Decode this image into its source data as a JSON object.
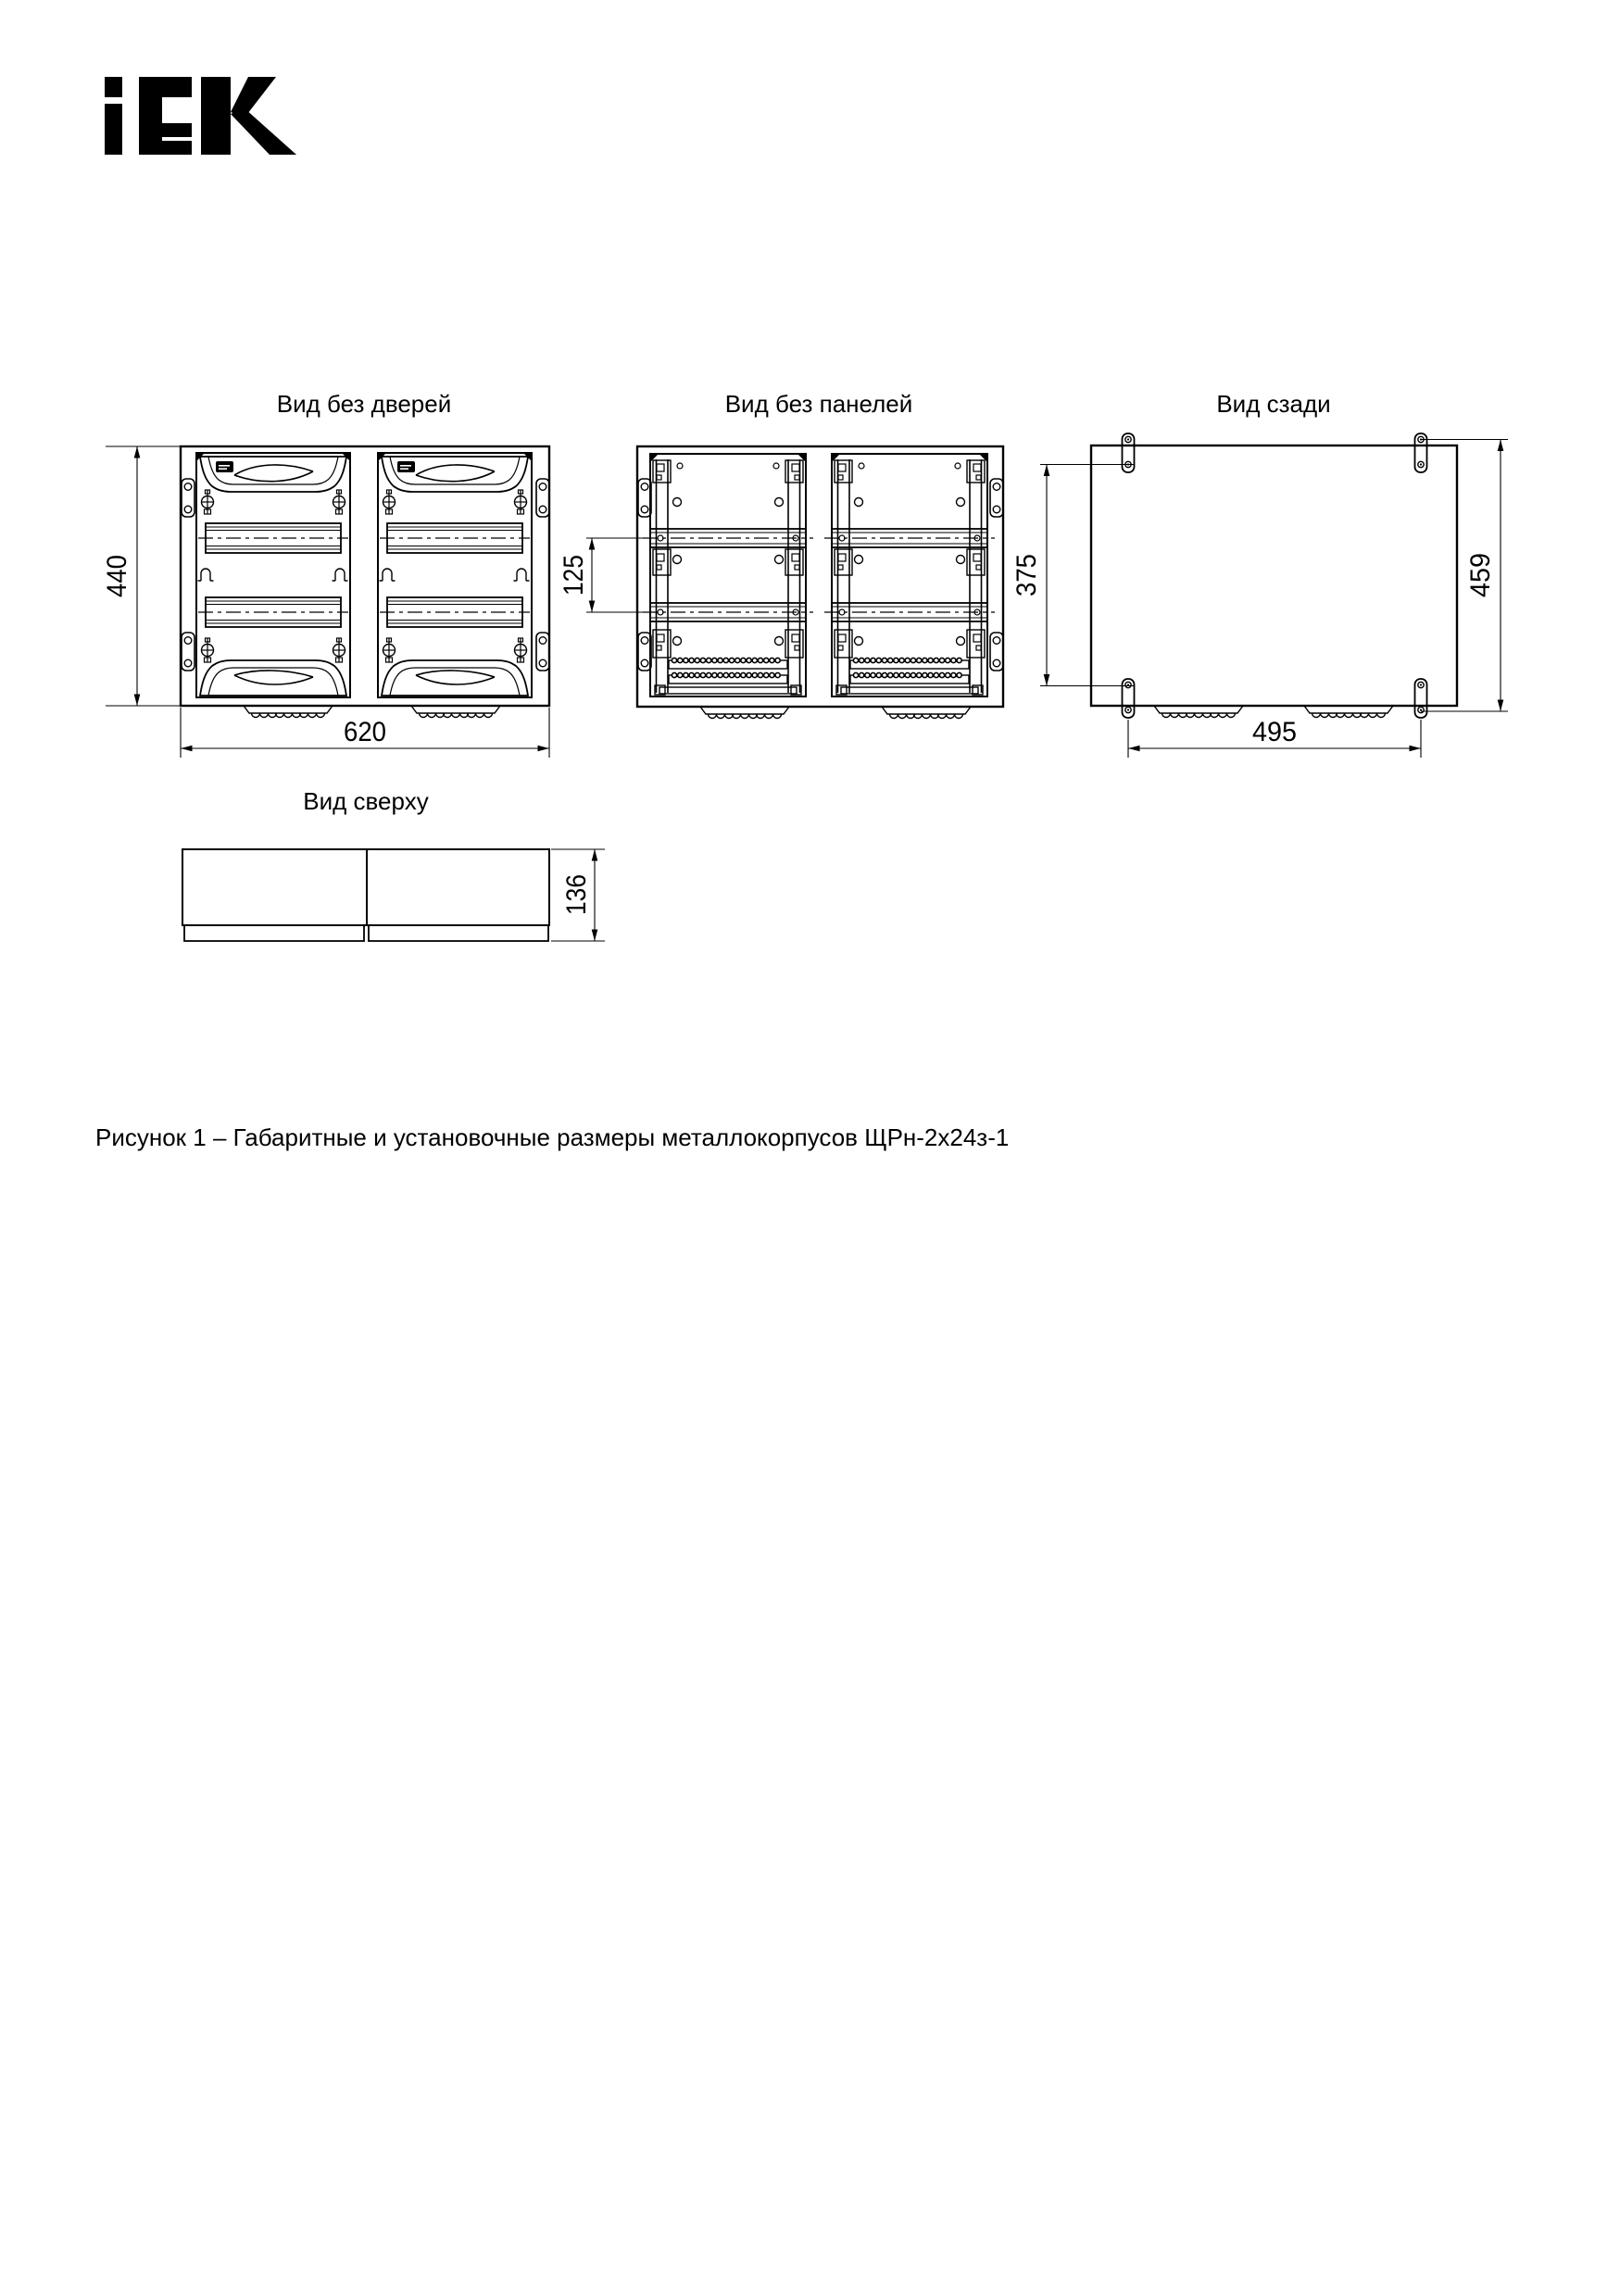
{
  "brand": {
    "name": "IEK"
  },
  "figure": {
    "views": [
      {
        "title": "Вид без дверей",
        "dims": {
          "height": "440",
          "width": "620"
        }
      },
      {
        "title": "Вид без панелей",
        "dims": {
          "rail_pitch": "125"
        }
      },
      {
        "title": "Вид сзади",
        "dims": {
          "mount_vertical": "375",
          "overall_height": "459",
          "mount_horizontal": "495"
        }
      },
      {
        "title": "Вид сверху",
        "dims": {
          "depth": "136"
        }
      }
    ],
    "caption": "Рисунок 1 – Габаритные и установочные размеры металлокорпусов ЩРн-2х24з-1"
  }
}
